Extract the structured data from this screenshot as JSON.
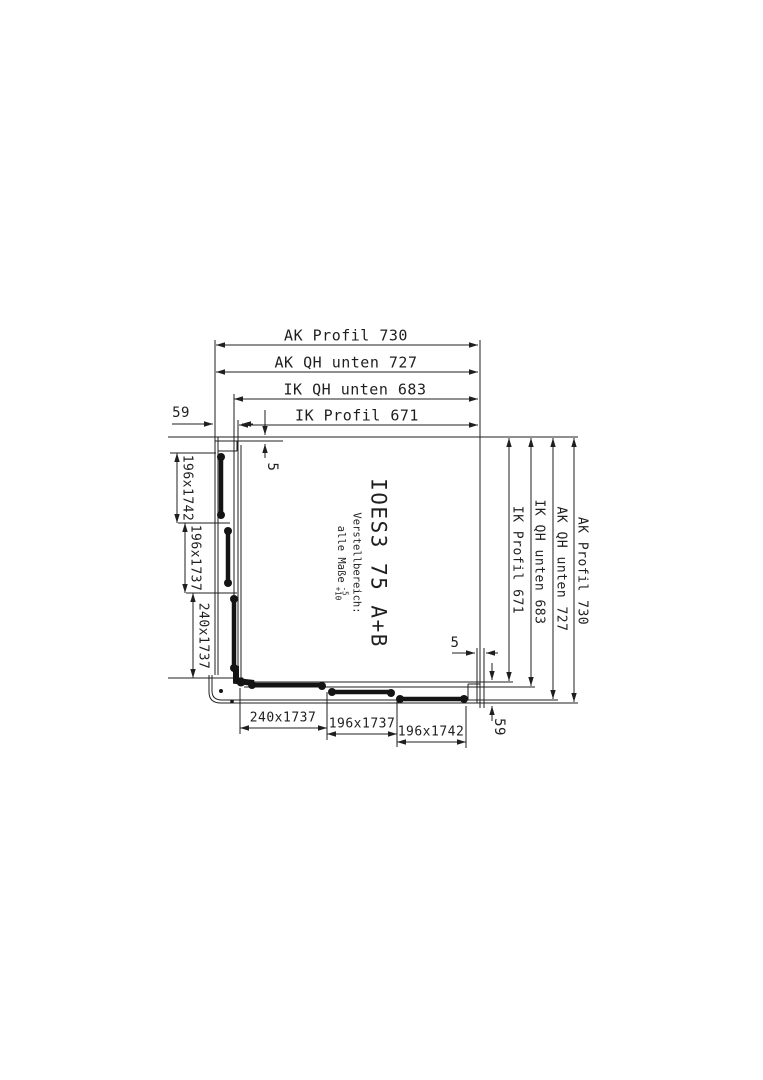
{
  "page": {
    "background": "#ffffff"
  },
  "drawing": {
    "model": "IOES3 75 A+B",
    "note": {
      "line1": "Verstellbereich:",
      "line2": "alle Maße",
      "tol_minus": "-5",
      "tol_plus": "+10"
    },
    "dims": {
      "top": [
        "AK Profil 730",
        "AK QH unten 727",
        "IK QH unten 683",
        "IK Profil 671"
      ],
      "right": [
        "IK Profil 671",
        "IK QH unten 683",
        "AK QH unten 727",
        "AK Profil 730"
      ],
      "left": [
        "196x1742",
        "196x1737",
        "240x1737"
      ],
      "bottom": [
        "240x1737",
        "196x1737",
        "196x1742"
      ],
      "profile_offset_top_left": "59",
      "gap_top": "5",
      "gap_bottom_right": "5",
      "profile_offset_bottom_right": "59"
    },
    "colors": {
      "line": "#1f1f1f",
      "text": "#1f1f1f"
    }
  }
}
